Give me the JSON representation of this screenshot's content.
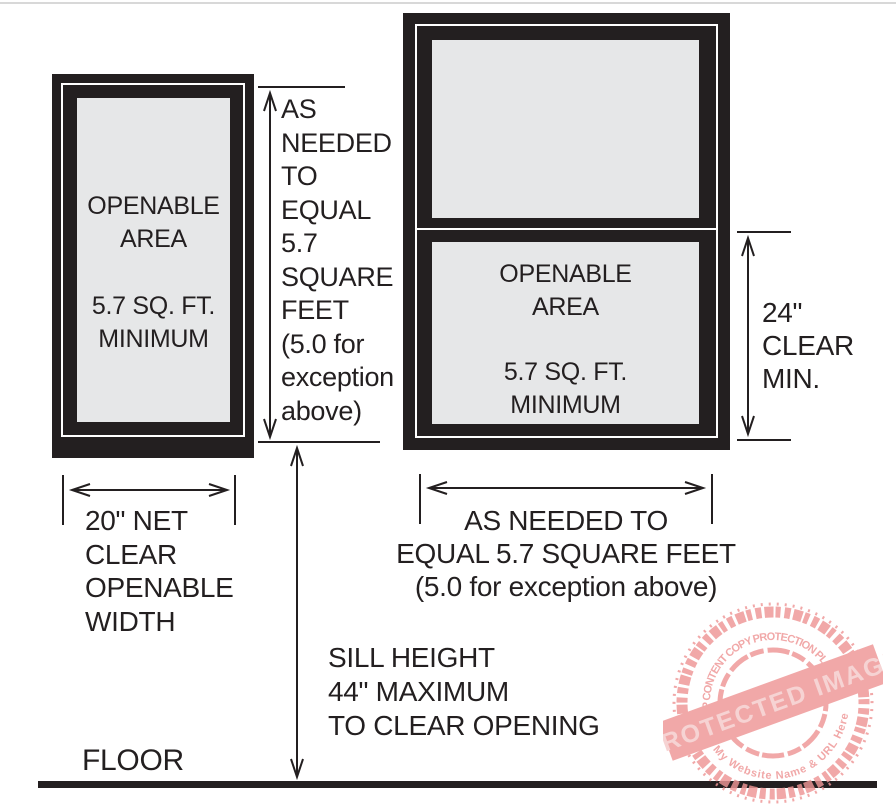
{
  "colors": {
    "frame_black": "#231f20",
    "pane_gray": "#e6e7e8",
    "ink": "#231f20",
    "top_rule_gray": "#d8d8d8",
    "stamp_pink": "#ee9696",
    "stamp_band_text": "#f5caca"
  },
  "left_window": {
    "openable_label": "OPENABLE\nAREA",
    "minimum_label": "5.7 SQ. FT.\nMINIMUM"
  },
  "right_window": {
    "openable_label": "OPENABLE\nAREA",
    "minimum_label": "5.7 SQ. FT.\nMINIMUM"
  },
  "dimensions": {
    "height_as_needed": "AS\nNEEDED\nTO\nEQUAL\n5.7\nSQUARE\nFEET\n(5.0 for\nexception\nabove)",
    "width_left": "20\" NET\nCLEAR\nOPENABLE\nWIDTH",
    "width_right": "AS NEEDED TO\nEQUAL 5.7 SQUARE FEET\n(5.0 for exception above)",
    "clear_height_right": "24\"\nCLEAR\nMIN.",
    "sill_height": "SILL HEIGHT\n44\" MAXIMUM\nTO CLEAR OPENING"
  },
  "floor_label": "FLOOR",
  "watermark": {
    "arc_top": "WP CONTENT COPY PROTECTION PLUGIN",
    "arc_bottom": "My Website Name & URL Here",
    "band": "PROTECTED IMAGE"
  }
}
